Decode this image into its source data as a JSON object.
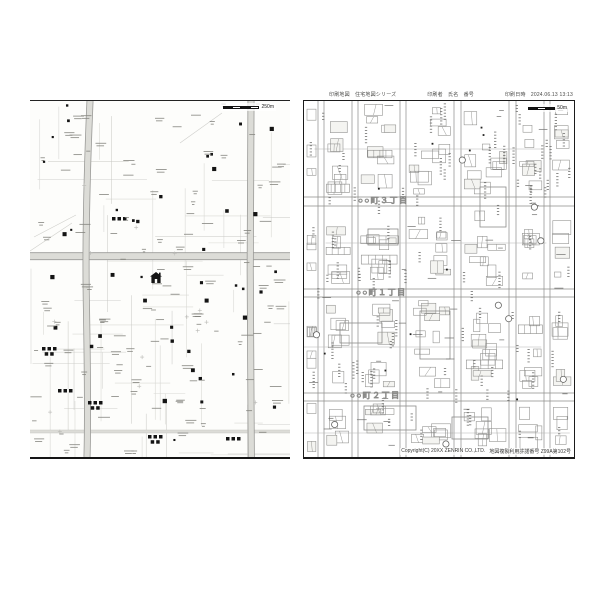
{
  "header": {
    "print_map": "印刷地図　住宅地図シリーズ",
    "print_user": "印刷者　氏名　番号",
    "print_datetime": "印刷日時　2024.06.13 13:13"
  },
  "left_map": {
    "scale_label": "250m",
    "marker_icon": "house-current-location-icon"
  },
  "right_map": {
    "scale_label": "50m",
    "district_labels": [
      {
        "text": "○○町３丁目"
      },
      {
        "text": "○○町１丁目"
      },
      {
        "text": "○○町２丁目"
      }
    ],
    "copyright": "Copyright(C) 20XX ZENRIN CO.,LTD.",
    "license": "地図複製利用許諾番号 Z99A第102号"
  },
  "colors": {
    "page_bg": "#ffffff",
    "map_bg": "#fdfdfb",
    "road_fill": "#dcdcd7",
    "road_edge": "#9a9a97",
    "street_light": "#d9d9d5",
    "street_mid": "#c7c7c3",
    "building_stroke": "#8c8c8a",
    "microtext": "#85857f",
    "marker_black": "#141414",
    "panel_border": "#1b1b1b"
  }
}
